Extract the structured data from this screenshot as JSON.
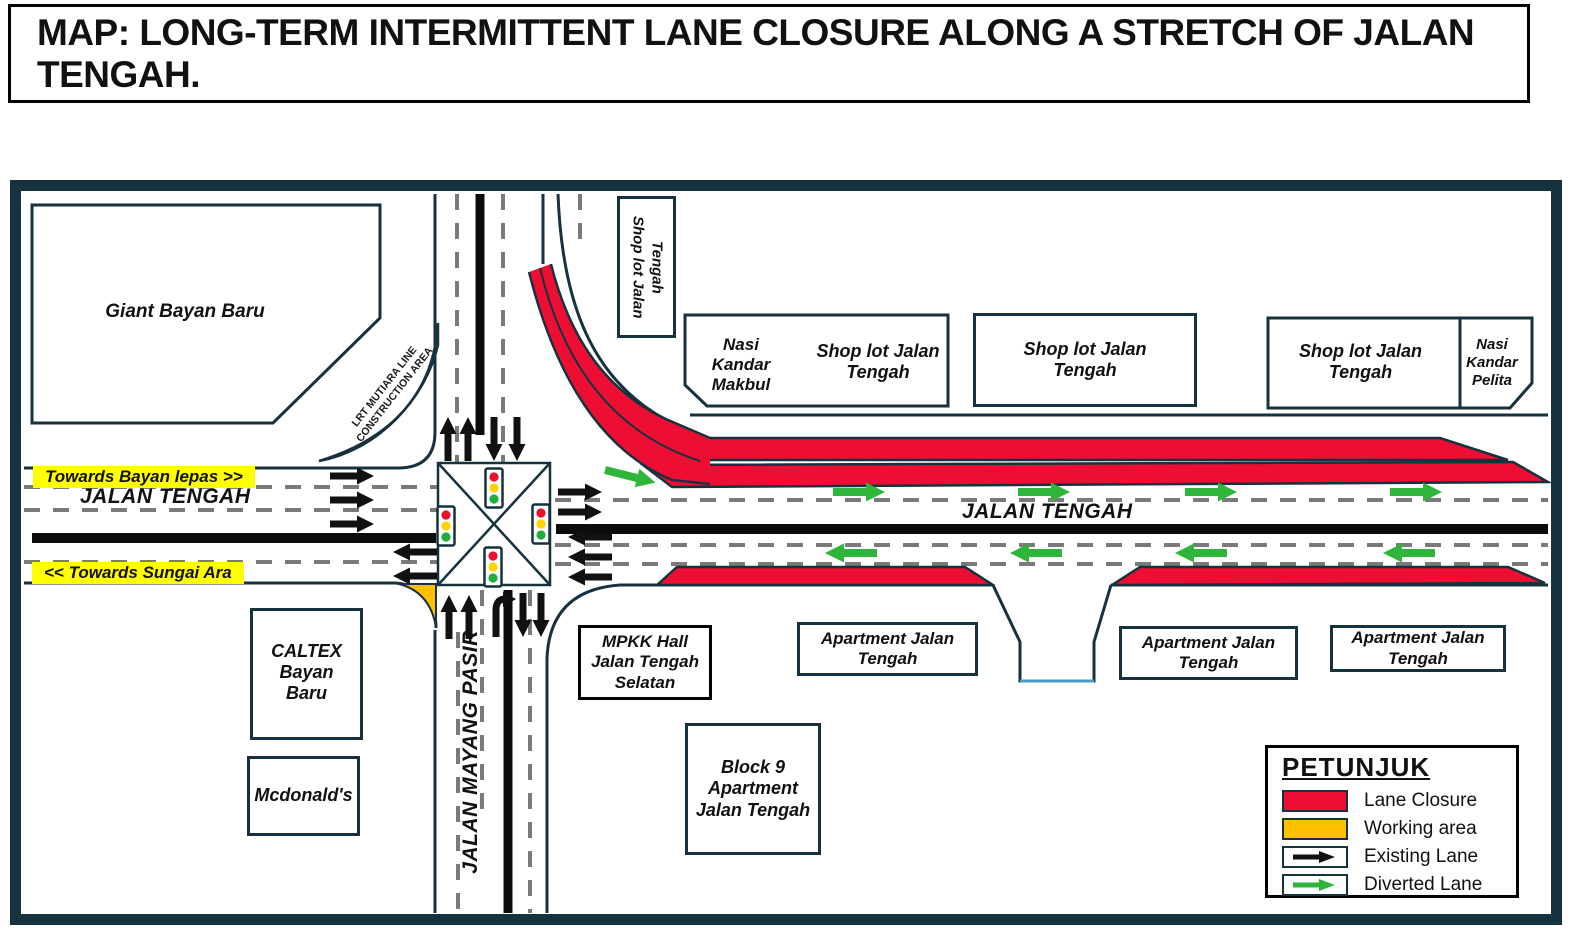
{
  "title": "MAP: LONG-TERM INTERMITTENT LANE CLOSURE ALONG A STRETCH OF JALAN TENGAH.",
  "colors": {
    "lane_closure": "#EF0E33",
    "working_area": "#FFC000",
    "existing_lane": "#111111",
    "diverted_lane": "#2FB53A",
    "outline": "#15323E",
    "highlight": "#FFFF00"
  },
  "roads": {
    "jalan_tengah_west": "JALAN TENGAH",
    "jalan_tengah_east": "JALAN TENGAH",
    "jalan_mayang_pasir": "JALAN MAYANG PASIR",
    "towards_bayan_lepas": "Towards Bayan lepas >>",
    "towards_sungai_ara": "<< Towards Sungai Ara"
  },
  "areas": {
    "lrt_construction": "LRT MUTIARA LINE CONSTRUCTION AREA"
  },
  "buildings": {
    "giant": "Giant Bayan Baru",
    "shoplot_vertical": "Shop lot Jalan Tengah",
    "nasi_kandar_makbul": "Nasi Kandar Makbul",
    "shoplot_a": "Shop lot Jalan Tengah",
    "shoplot_b": "Shop lot Jalan Tengah",
    "shoplot_c": "Shop lot Jalan Tengah",
    "nasi_kandar_pelita": "Nasi Kandar Pelita",
    "caltex": "CALTEX Bayan Baru",
    "mcdonalds": "Mcdonald's",
    "mpkk_hall": "MPKK  Hall Jalan Tengah Selatan",
    "apartment_1": "Apartment Jalan Tengah",
    "apartment_2": "Apartment Jalan Tengah",
    "apartment_3": "Apartment Jalan Tengah",
    "block9": "Block 9 Apartment Jalan Tengah"
  },
  "legend": {
    "title": "PETUNJUK",
    "items": [
      {
        "label": "Lane Closure"
      },
      {
        "label": "Working area"
      },
      {
        "label": "Existing Lane"
      },
      {
        "label": "Diverted Lane"
      }
    ]
  }
}
